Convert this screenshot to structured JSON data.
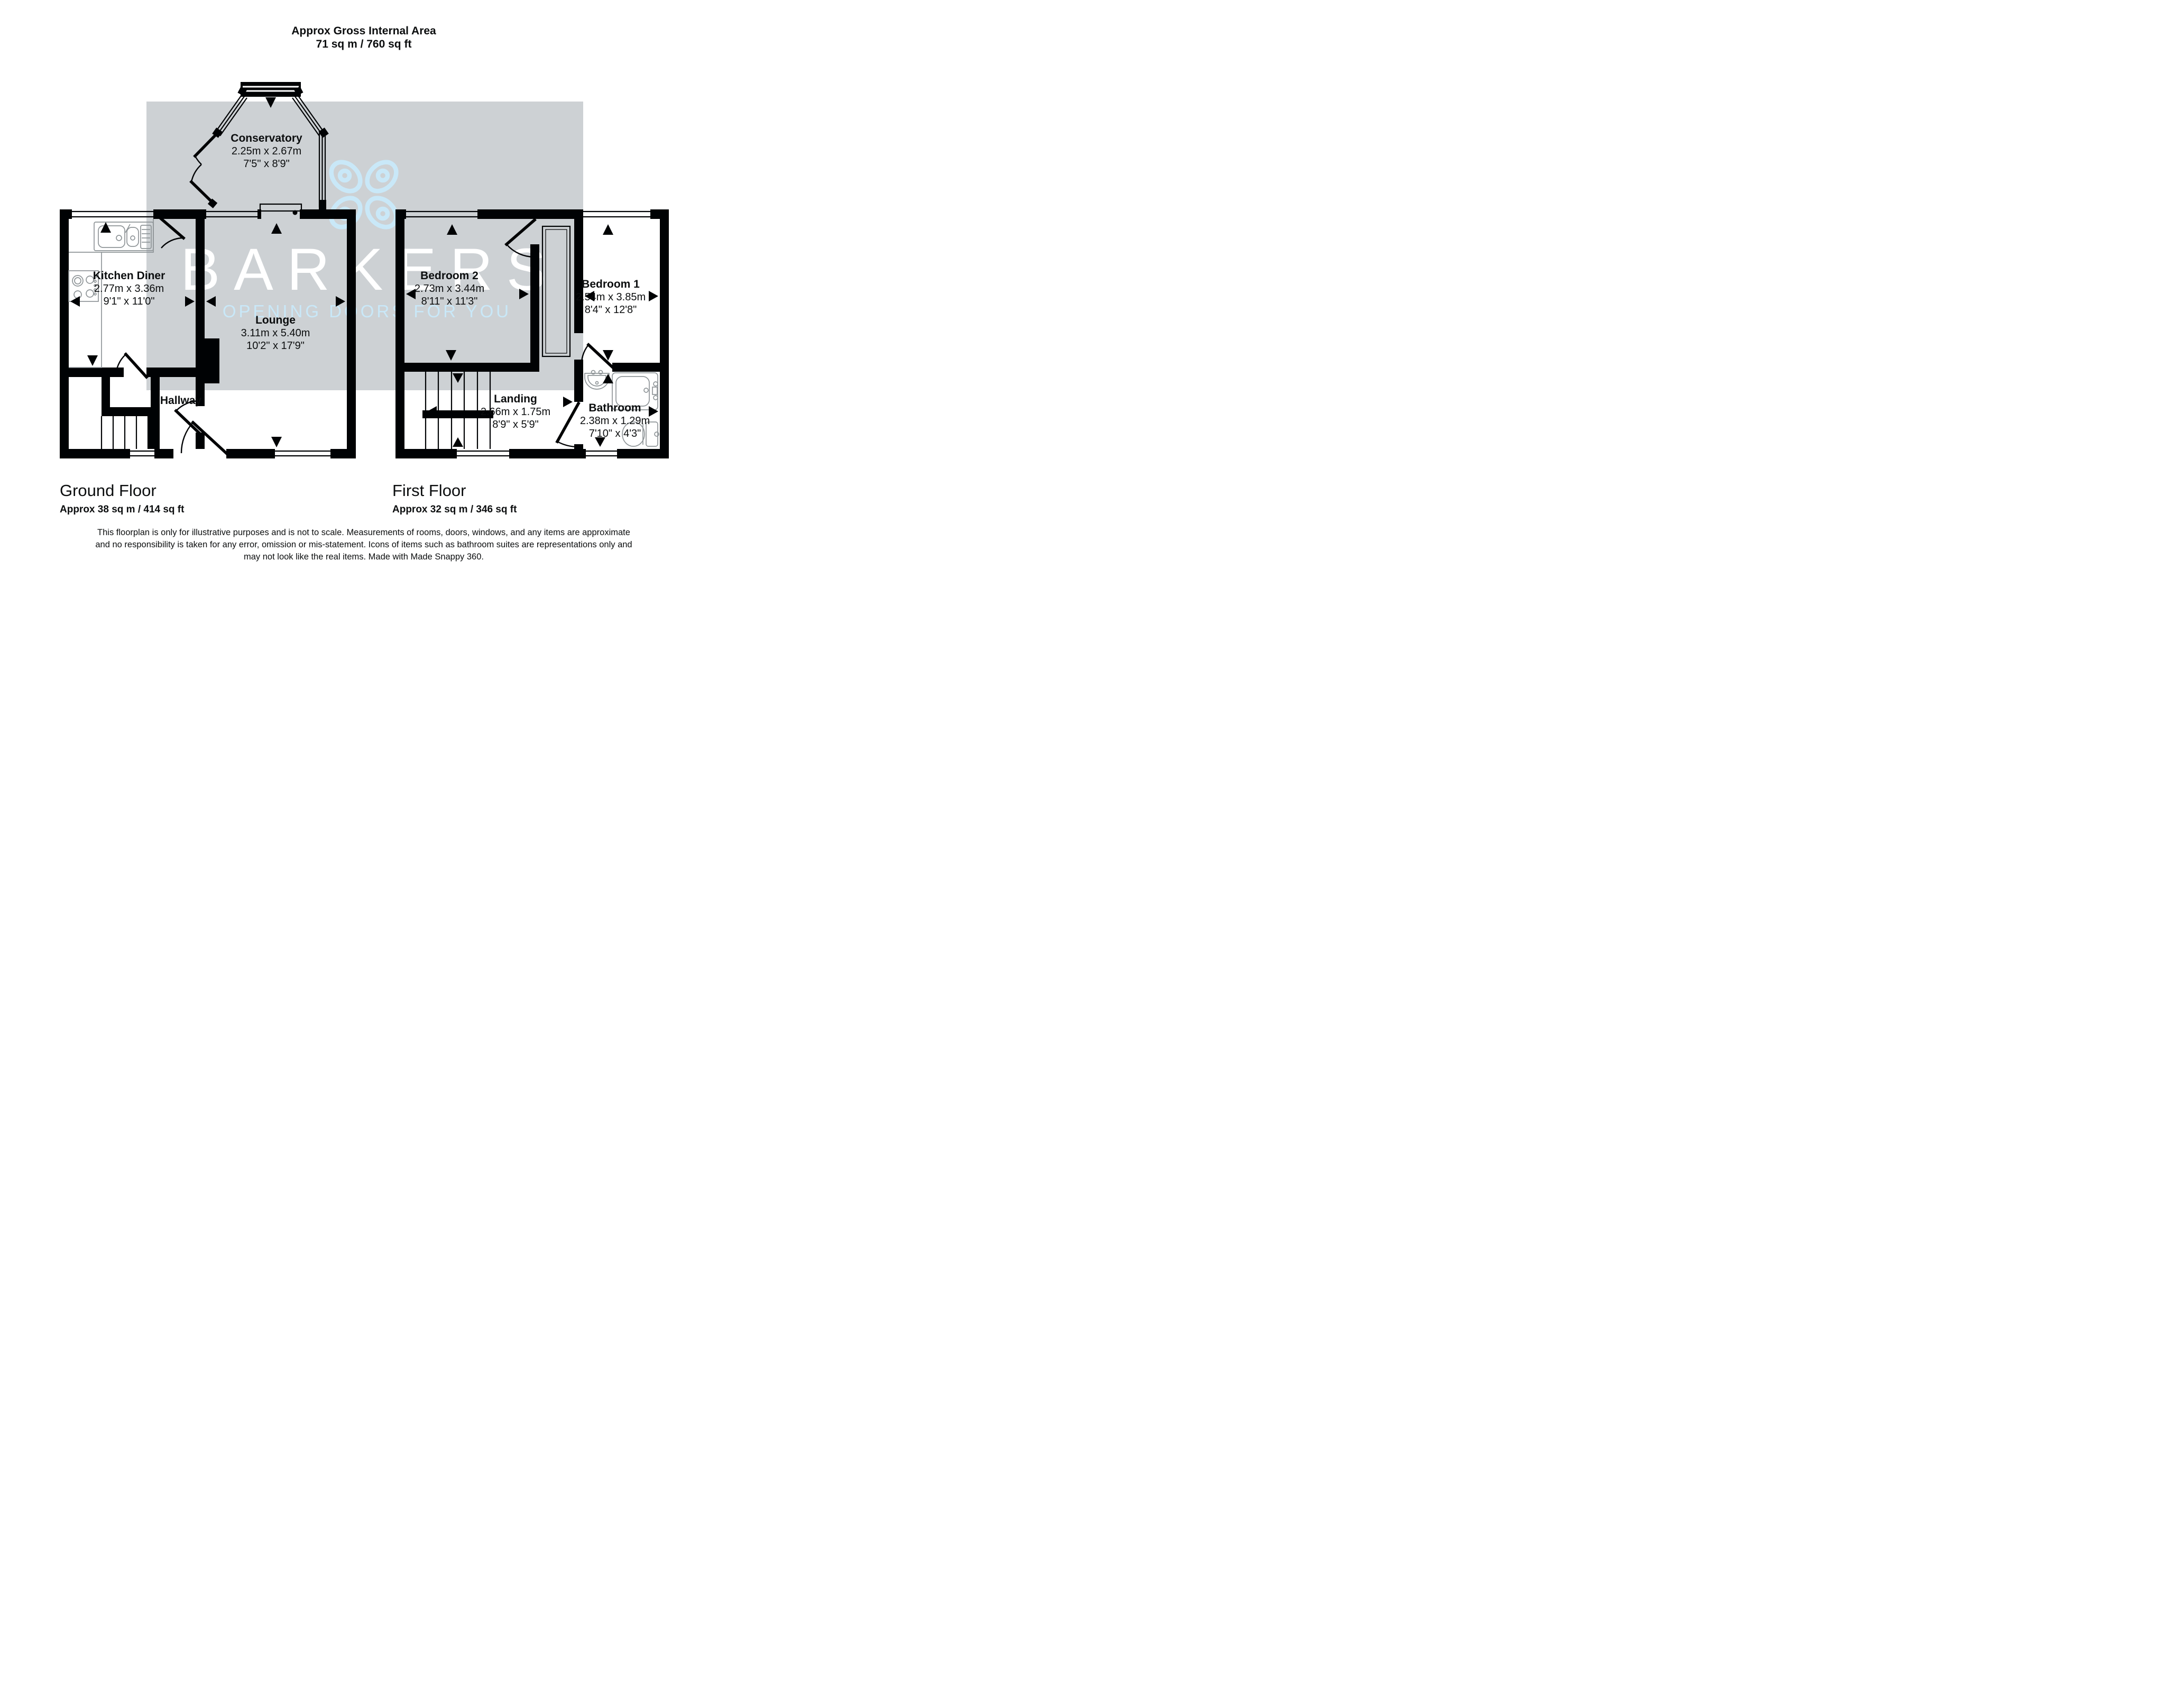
{
  "header": {
    "title": "Approx Gross Internal Area",
    "area": "71 sq m / 760 sq ft"
  },
  "watermark": {
    "brand": "BARKERS",
    "tagline": "OPENING DOORS FOR YOU",
    "accent_color": "#c9e8f8",
    "panel_color": "#cdd1d4",
    "logo": "four-petal-clover-icon"
  },
  "rooms": {
    "conservatory": {
      "name": "Conservatory",
      "metric": "2.25m x 2.67m",
      "imperial": "7'5\" x 8'9\""
    },
    "kitchen": {
      "name": "Kitchen Diner",
      "metric": "2.77m x 3.36m",
      "imperial": "9'1\" x 11'0\""
    },
    "lounge": {
      "name": "Lounge",
      "metric": "3.11m x 5.40m",
      "imperial": "10'2\" x 17'9\""
    },
    "hallway": {
      "name": "Hallway"
    },
    "bedroom2": {
      "name": "Bedroom 2",
      "metric": "2.73m x 3.44m",
      "imperial": "8'11\" x 11'3\""
    },
    "bedroom1": {
      "name": "Bedroom 1",
      "metric": "2.54m x 3.85m",
      "imperial": "8'4\" x 12'8\""
    },
    "landing": {
      "name": "Landing",
      "metric": "2.66m x 1.75m",
      "imperial": "8'9\" x 5'9\""
    },
    "bathroom": {
      "name": "Bathroom",
      "metric": "2.38m x 1.29m",
      "imperial": "7'10\" x 4'3\""
    }
  },
  "floors": {
    "ground": {
      "label": "Ground Floor",
      "area": "Approx 38 sq m / 414 sq ft"
    },
    "first": {
      "label": "First Floor",
      "area": "Approx 32 sq m / 346 sq ft"
    }
  },
  "disclaimer": {
    "line1": "This floorplan is only for illustrative purposes and is not to scale. Measurements of rooms, doors, windows, and any items are approximate",
    "line2": "and no responsibility is taken for any error, omission or mis-statement. Icons of items such as bathroom suites are representations only and",
    "line3": "may not look like the real items. Made with Made Snappy 360."
  }
}
